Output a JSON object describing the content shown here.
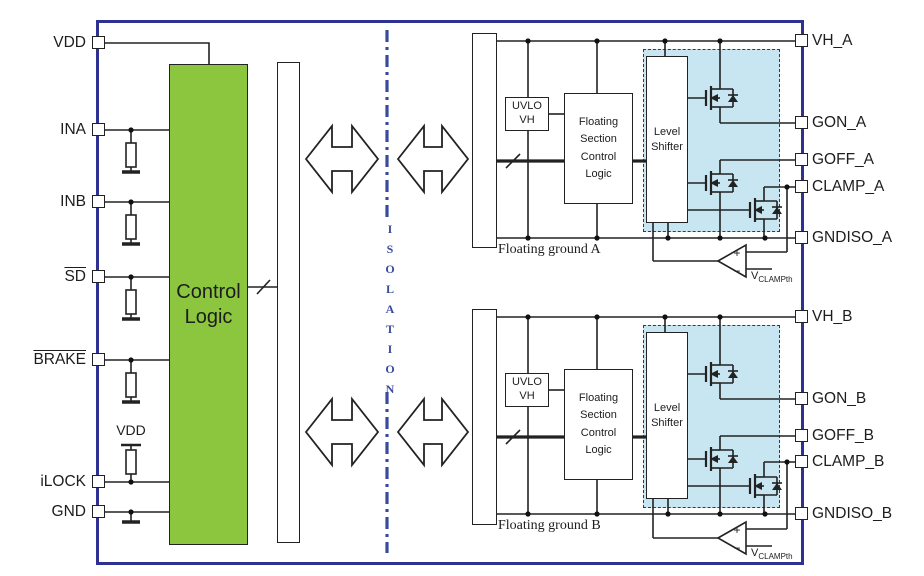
{
  "pins": {
    "left": [
      {
        "label": "VDD",
        "overline": false
      },
      {
        "label": "INA",
        "overline": false
      },
      {
        "label": "INB",
        "overline": false
      },
      {
        "label": "SD",
        "overline": true
      },
      {
        "label": "BRAKE",
        "overline": true
      },
      {
        "label": "iLOCK",
        "overline": false
      },
      {
        "label": "GND",
        "overline": false
      }
    ],
    "right_a": [
      "VH_A",
      "GON_A",
      "GOFF_A",
      "CLAMP_A",
      "GNDISO_A"
    ],
    "right_b": [
      "VH_B",
      "GON_B",
      "GOFF_B",
      "CLAMP_B",
      "GNDISO_B"
    ]
  },
  "blocks": {
    "control_logic": "Control Logic",
    "uvlo_line1": "UVLO",
    "uvlo_line2": "VH",
    "floating_section_logic": "Floating Section Control Logic",
    "level_shifter": "Level Shifter"
  },
  "labels": {
    "isolation": "ISOLATION",
    "floating_ground_a": "Floating ground A",
    "floating_ground_b": "Floating ground B",
    "vdd_pullup": "VDD",
    "vclamp_v": "V",
    "vclamp_sub": "CLAMPth",
    "comparator_plus": "+",
    "comparator_minus": "−"
  },
  "colors": {
    "border_blue": "#2e3192",
    "isolation_blue": "#3a4b9e",
    "control_logic_green": "#8cc63f",
    "driver_region_blue": "#c7e6f1",
    "wire_black": "#222222"
  }
}
